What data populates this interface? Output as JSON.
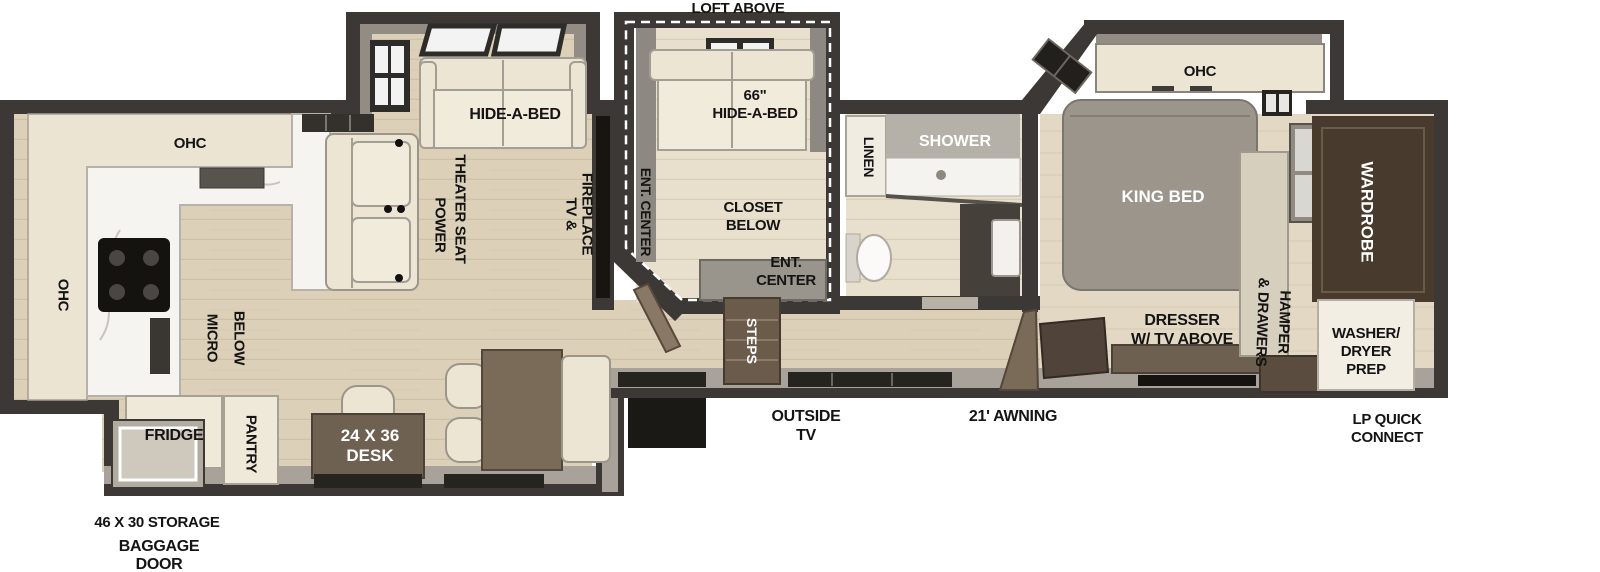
{
  "figure": "rv-fifth-wheel-floorplan",
  "colors": {
    "wall": "#3b3835",
    "wall_gray": "#a8a29a",
    "floor": "#dcd0b8",
    "floor_light": "#e8e0cc",
    "bedroom_floor": "#e2d8c3",
    "cream_furniture": "#ece5d4",
    "brown_furniture": "#6e5f4f",
    "dark_brown": "#483a2c",
    "bed_gray": "#9c958b",
    "steps_brown": "#6b5b4b",
    "label_text": "#141414",
    "label_inverse": "#ffffff"
  },
  "labels": {
    "loft_above": "LOFT ABOVE",
    "kitchen_ohc_top": "OHC",
    "kitchen_ohc_left": "OHC",
    "micro_below": [
      "MICRO",
      "BELOW"
    ],
    "fridge": "FRIDGE",
    "pantry": "PANTRY",
    "desk": [
      "24 X 36",
      "DESK"
    ],
    "storage": "46 X 30 STORAGE",
    "baggage_door": [
      "BAGGAGE",
      "DOOR"
    ],
    "hide_a_bed": "HIDE-A-BED",
    "power_theater_seat": [
      "POWER",
      "THEATER SEAT"
    ],
    "tv_fireplace": [
      "TV &",
      "FIREPLACE"
    ],
    "ent_center_side": "ENT. CENTER",
    "hide_a_bed_66": [
      "66\"",
      "HIDE-A-BED"
    ],
    "closet_below": [
      "CLOSET",
      "BELOW"
    ],
    "ent_center_bottom": [
      "ENT.",
      "CENTER"
    ],
    "steps": "STEPS",
    "outside_tv": [
      "OUTSIDE",
      "TV"
    ],
    "awning": "21' AWNING",
    "linen": "LINEN",
    "shower": "SHOWER",
    "bedroom_ohc": "OHC",
    "king_bed": "KING BED",
    "dresser": [
      "DRESSER",
      "W/ TV ABOVE"
    ],
    "hamper": [
      "HAMPER",
      "& DRAWERS"
    ],
    "wardrobe": "WARDROBE",
    "washer_dryer": [
      "WASHER/",
      "DRYER",
      "PREP"
    ],
    "lp_quick_connect": [
      "LP QUICK",
      "CONNECT"
    ]
  }
}
